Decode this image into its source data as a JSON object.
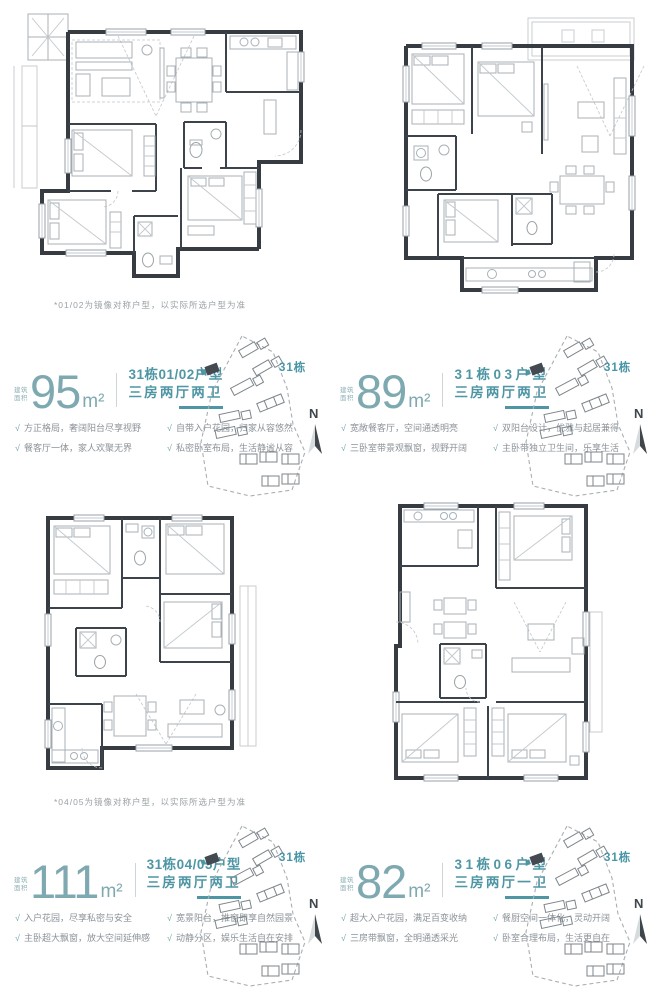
{
  "colors": {
    "accent": "#4f96a4",
    "number": "#7fa9b1",
    "feature_text": "#8b9298"
  },
  "icons": {
    "check_icon": "√"
  },
  "site_map": {
    "building_label": "31栋",
    "north_label": "N"
  },
  "units": [
    {
      "area_label_l1": "建筑",
      "area_label_l2": "面积",
      "area_value": "95",
      "area_unit": "m²",
      "title": "31栋01/02户型",
      "subtitle": "三房两厅两卫",
      "features": [
        "方正格局，奢阔阳台尽享视野",
        "自带入户花园，归家从容悠然",
        "餐客厅一体，家人欢聚无界",
        "私密卧室布局，生活静谧从容"
      ],
      "footnote": "*01/02为镜像对称户型，以实际所选户型为准"
    },
    {
      "area_label_l1": "建筑",
      "area_label_l2": "面积",
      "area_value": "89",
      "area_unit": "m²",
      "title": "31栋03户型",
      "subtitle": "三房两厅两卫",
      "features": [
        "宽敞餐客厅，空间通透明亮",
        "双阳台设计，优雅与起居兼得",
        "三卧室带景观飘窗，视野开阔",
        "主卧带独立卫生间，乐享生活"
      ]
    },
    {
      "area_label_l1": "建筑",
      "area_label_l2": "面积",
      "area_value": "111",
      "area_unit": "m²",
      "title": "31栋04/05户型",
      "subtitle": "三房两厅两卫",
      "features": [
        "入户花园，尽享私密与安全",
        "宽景阳台，推窗即享自然园景",
        "主卧超大飘窗，放大空间延伸感",
        "动静分区，娱乐生活自在安排"
      ],
      "footnote": "*04/05为镜像对称户型，以实际所选户型为准"
    },
    {
      "area_label_l1": "建筑",
      "area_label_l2": "面积",
      "area_value": "82",
      "area_unit": "m²",
      "title": "31栋06户型",
      "subtitle": "三房两厅一卫",
      "features": [
        "超大入户花园，满足百变收纳",
        "餐厨空间一体化，灵动开阔",
        "三房带飘窗，全明通透采光",
        "卧室合理布局，生活更自在"
      ]
    }
  ]
}
